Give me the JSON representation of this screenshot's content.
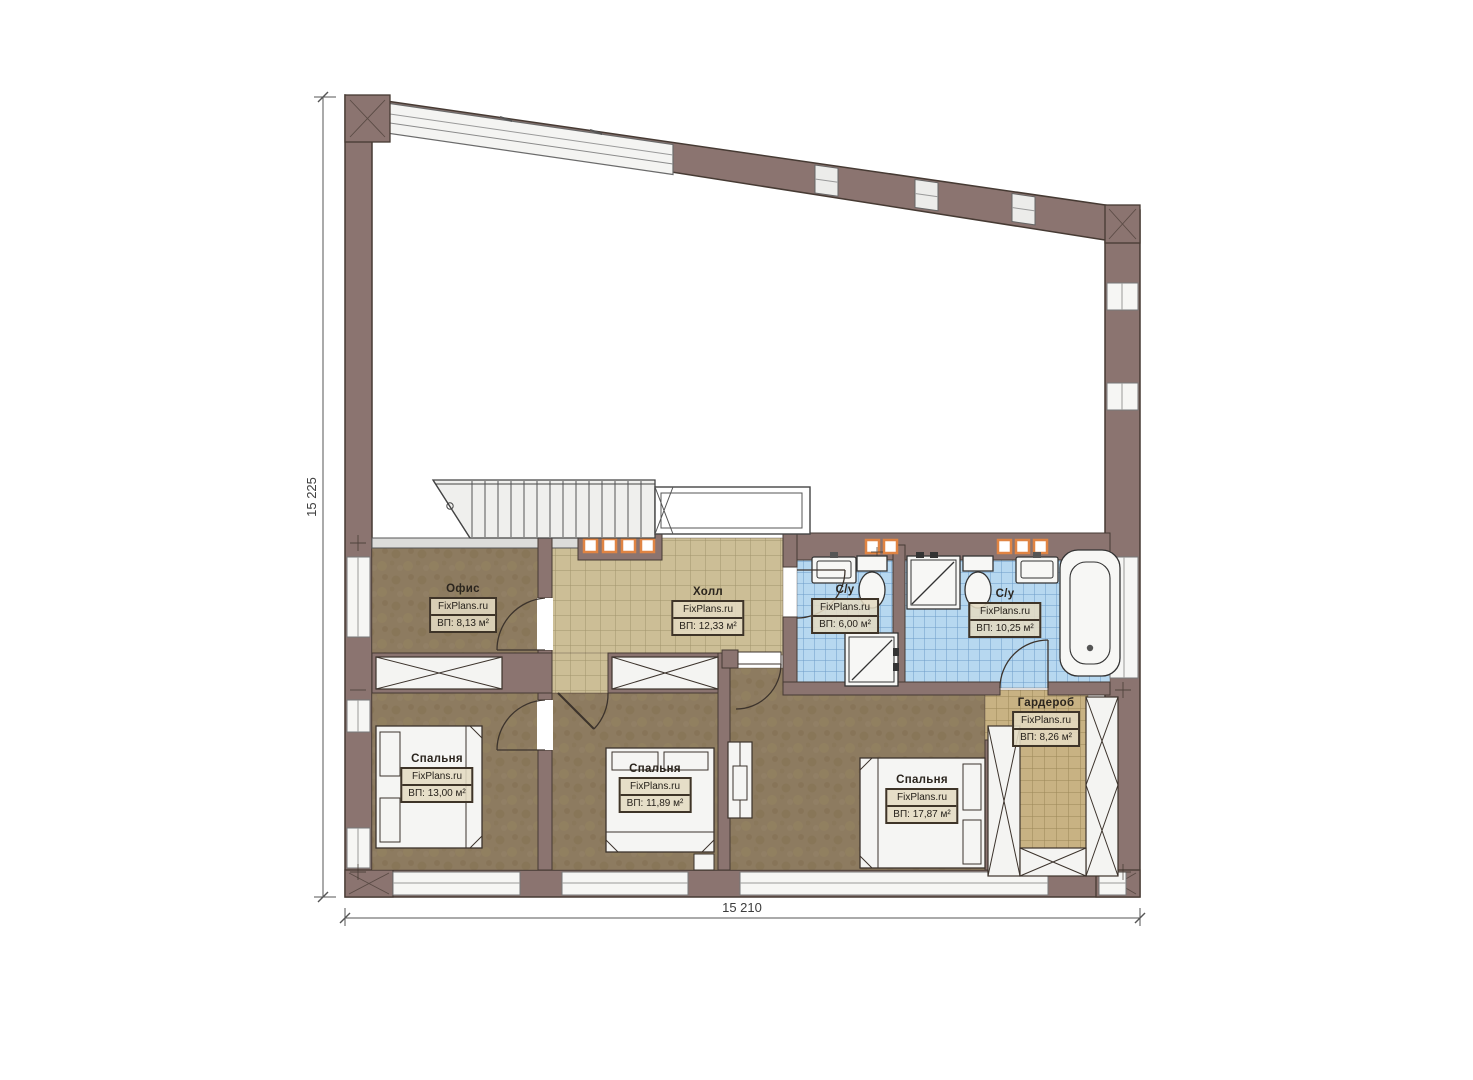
{
  "plan": {
    "title": "Floor plan - second level",
    "watermark": "FixPlans.ru",
    "dimensions": {
      "left": "15 225",
      "bottom": "15 210"
    },
    "rooms": [
      {
        "id": "office",
        "name": "Офис",
        "area": "ВП: 8,13 м²"
      },
      {
        "id": "hall",
        "name": "Холл",
        "area": "ВП: 12,33 м²"
      },
      {
        "id": "bath-small",
        "name": "С/у",
        "area": "ВП: 6,00 м²"
      },
      {
        "id": "bath-large",
        "name": "С/у",
        "area": "ВП: 10,25 м²"
      },
      {
        "id": "bedroom-1",
        "name": "Спальня",
        "area": "ВП: 13,00 м²"
      },
      {
        "id": "bedroom-2",
        "name": "Спальня",
        "area": "ВП: 11,89 м²"
      },
      {
        "id": "bedroom-3",
        "name": "Спальня",
        "area": "ВП: 17,87 м²"
      },
      {
        "id": "wardrobe",
        "name": "Гардероб",
        "area": "ВП: 8,26 м²"
      }
    ],
    "colors": {
      "wall": "#8b7470",
      "wall_outline": "#463a33",
      "floor_rooms": "#8d7b60",
      "floor_hall": "#ccbe96",
      "floor_bath": "#b7d8f0",
      "floor_wardrobe": "#c8b283",
      "glass_block_accent": "#e08443"
    }
  }
}
